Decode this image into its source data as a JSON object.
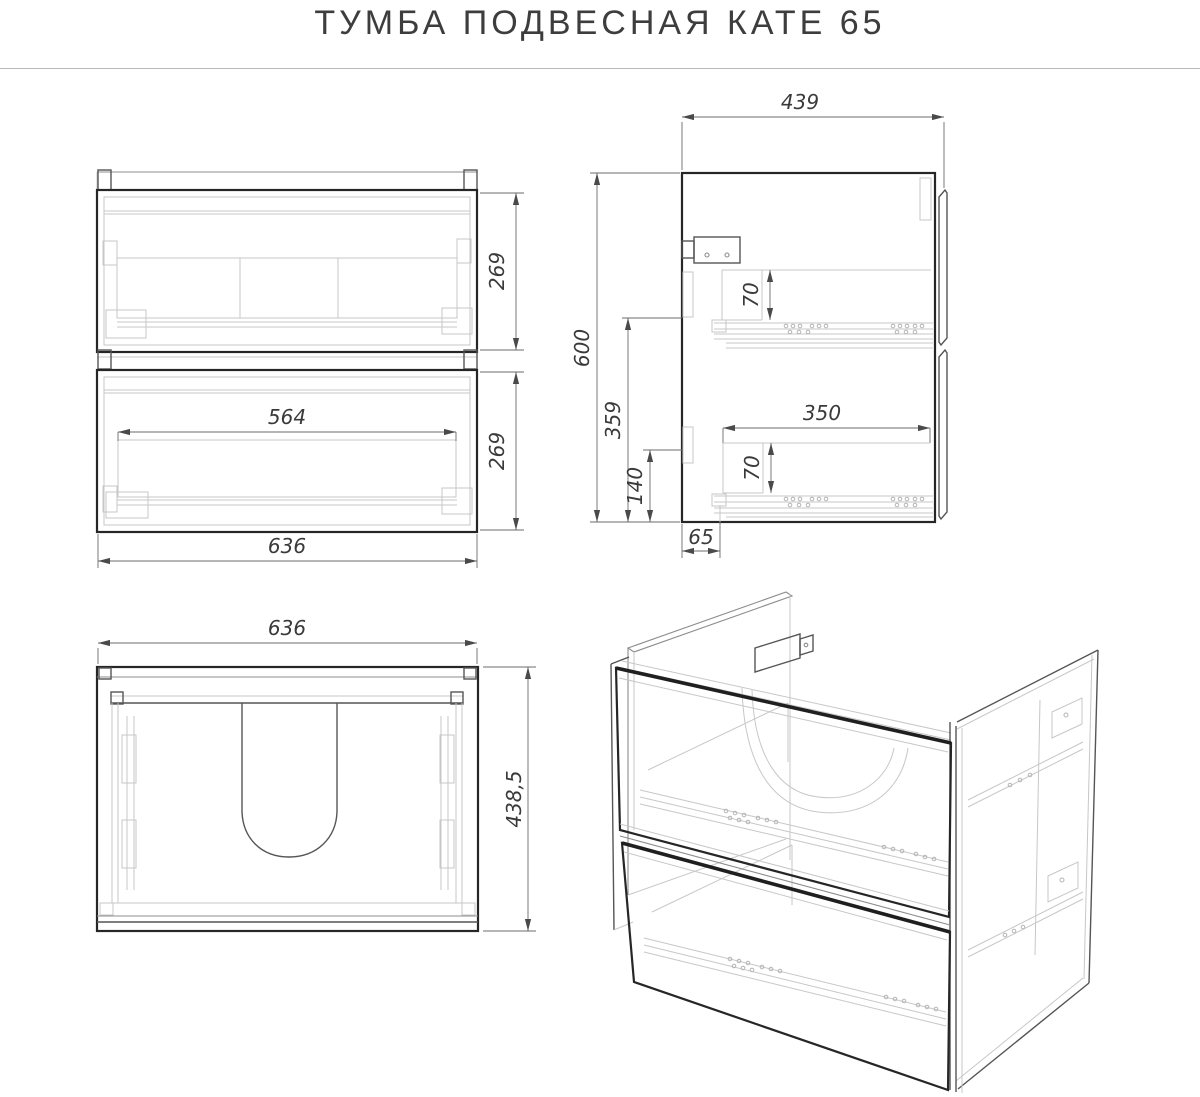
{
  "title": "ТУМБА ПОДВЕСНАЯ КАТЕ 65",
  "colors": {
    "background": "#ffffff",
    "outline_dark": "#262626",
    "line_medium": "#8c8c8c",
    "line_light": "#c7c7c7",
    "dimension_line": "#6b6b6b",
    "dimension_text": "#3a3a3a",
    "title_text": "#3d3d3d",
    "divider": "#b9b9b9"
  },
  "views": {
    "front": {
      "label": "front-view",
      "dims": {
        "total_width": "636",
        "inner_width": "564",
        "upper_drawer_height": "269",
        "lower_drawer_height": "269"
      }
    },
    "side": {
      "label": "side-view",
      "dims": {
        "depth": "439",
        "height": "600",
        "upper_slide_level": "359",
        "lower_slide_level": "140",
        "upper_drawer_side": "70",
        "lower_drawer_side": "70",
        "lower_drawer_depth": "350",
        "back_offset": "65"
      }
    },
    "top": {
      "label": "top-view",
      "dims": {
        "total_width": "636",
        "total_depth": "438,5"
      }
    },
    "isometric": {
      "label": "isometric-view"
    }
  }
}
